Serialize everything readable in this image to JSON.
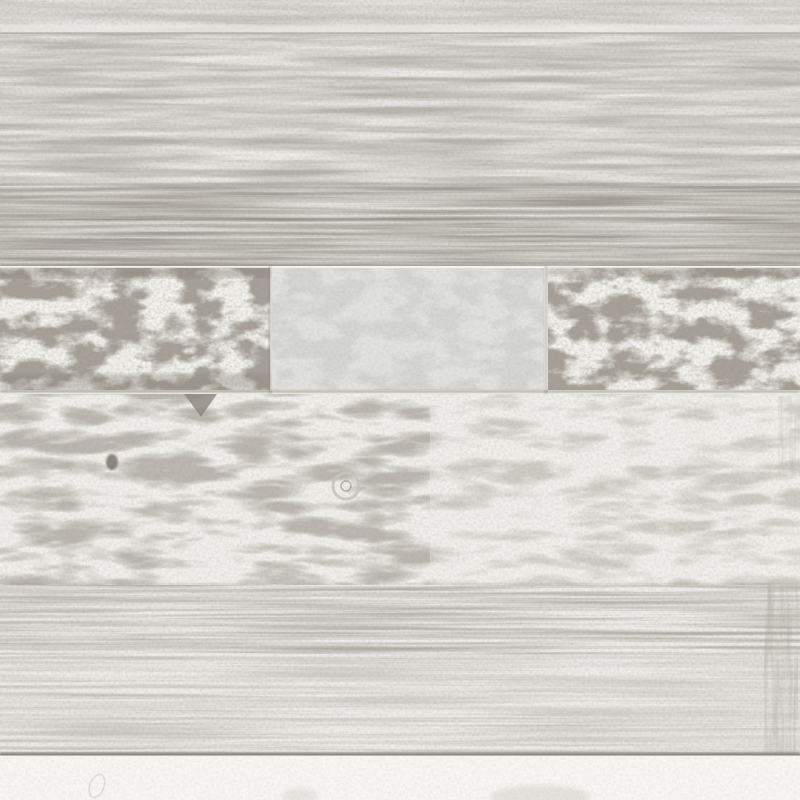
{
  "image": {
    "kind": "photographic texture",
    "subject": "Weathered whitewashed reclaimed wood wall of horizontal planks; middle row of short boards with peeling white paint over gray; knots and soft grain; near-white strip at bottom",
    "width_px": 800,
    "height_px": 800
  },
  "palette": {
    "top_strip": "#cac7c2",
    "plank_light": "#d6d3ce",
    "plank_medium": "#b5b1aa",
    "streak_white": "#f3f2ef",
    "streak_dark": "#8f8a82",
    "board_white": "#f3f2ee",
    "board_gray": "#d5d5d2",
    "patch_gray": "#9a948b",
    "gap_line": "#8b857c",
    "big_plank": "#f0efeb",
    "grain_gray": "#c7c3bc",
    "knot_brown": "#6e6456",
    "fine_plank": "#edece8",
    "fine_streak": "#c5c1bb",
    "bottom_strip": "#f7f6f3",
    "bottom_line": "#8a857d",
    "edge_band": "#aaa59d",
    "leaf": "#dbd8d2"
  },
  "planks": [
    {
      "row": 1,
      "y": 0,
      "height": 34,
      "tone": "medium gray strip"
    },
    {
      "row": 2,
      "y": 34,
      "height": 152,
      "tone": "light gray plank, soft horizontal paint streaks"
    },
    {
      "row": 3,
      "y": 186,
      "height": 80,
      "tone": "darker gray plank, strong grain streaks"
    },
    {
      "row": 4,
      "y": 266,
      "height": 128,
      "tone": "three short boards: peeling-white, plain gray, peeling-white"
    },
    {
      "row": 5,
      "y": 394,
      "height": 191,
      "tone": "whitewashed plank, swirling grain, dark notch, brown knot, knot ring"
    },
    {
      "row": 6,
      "y": 585,
      "height": 170,
      "tone": "pale plank with fine straight grain, darker right edge"
    },
    {
      "row": 7,
      "y": 755,
      "height": 45,
      "tone": "near-white strip with faint leaf imprints"
    }
  ],
  "details": {
    "board_seams_x": [
      270,
      545
    ],
    "knot_ring_center": [
      346,
      486
    ],
    "dark_knot_center": [
      112,
      462
    ],
    "notch_x_range": [
      184,
      217
    ]
  }
}
